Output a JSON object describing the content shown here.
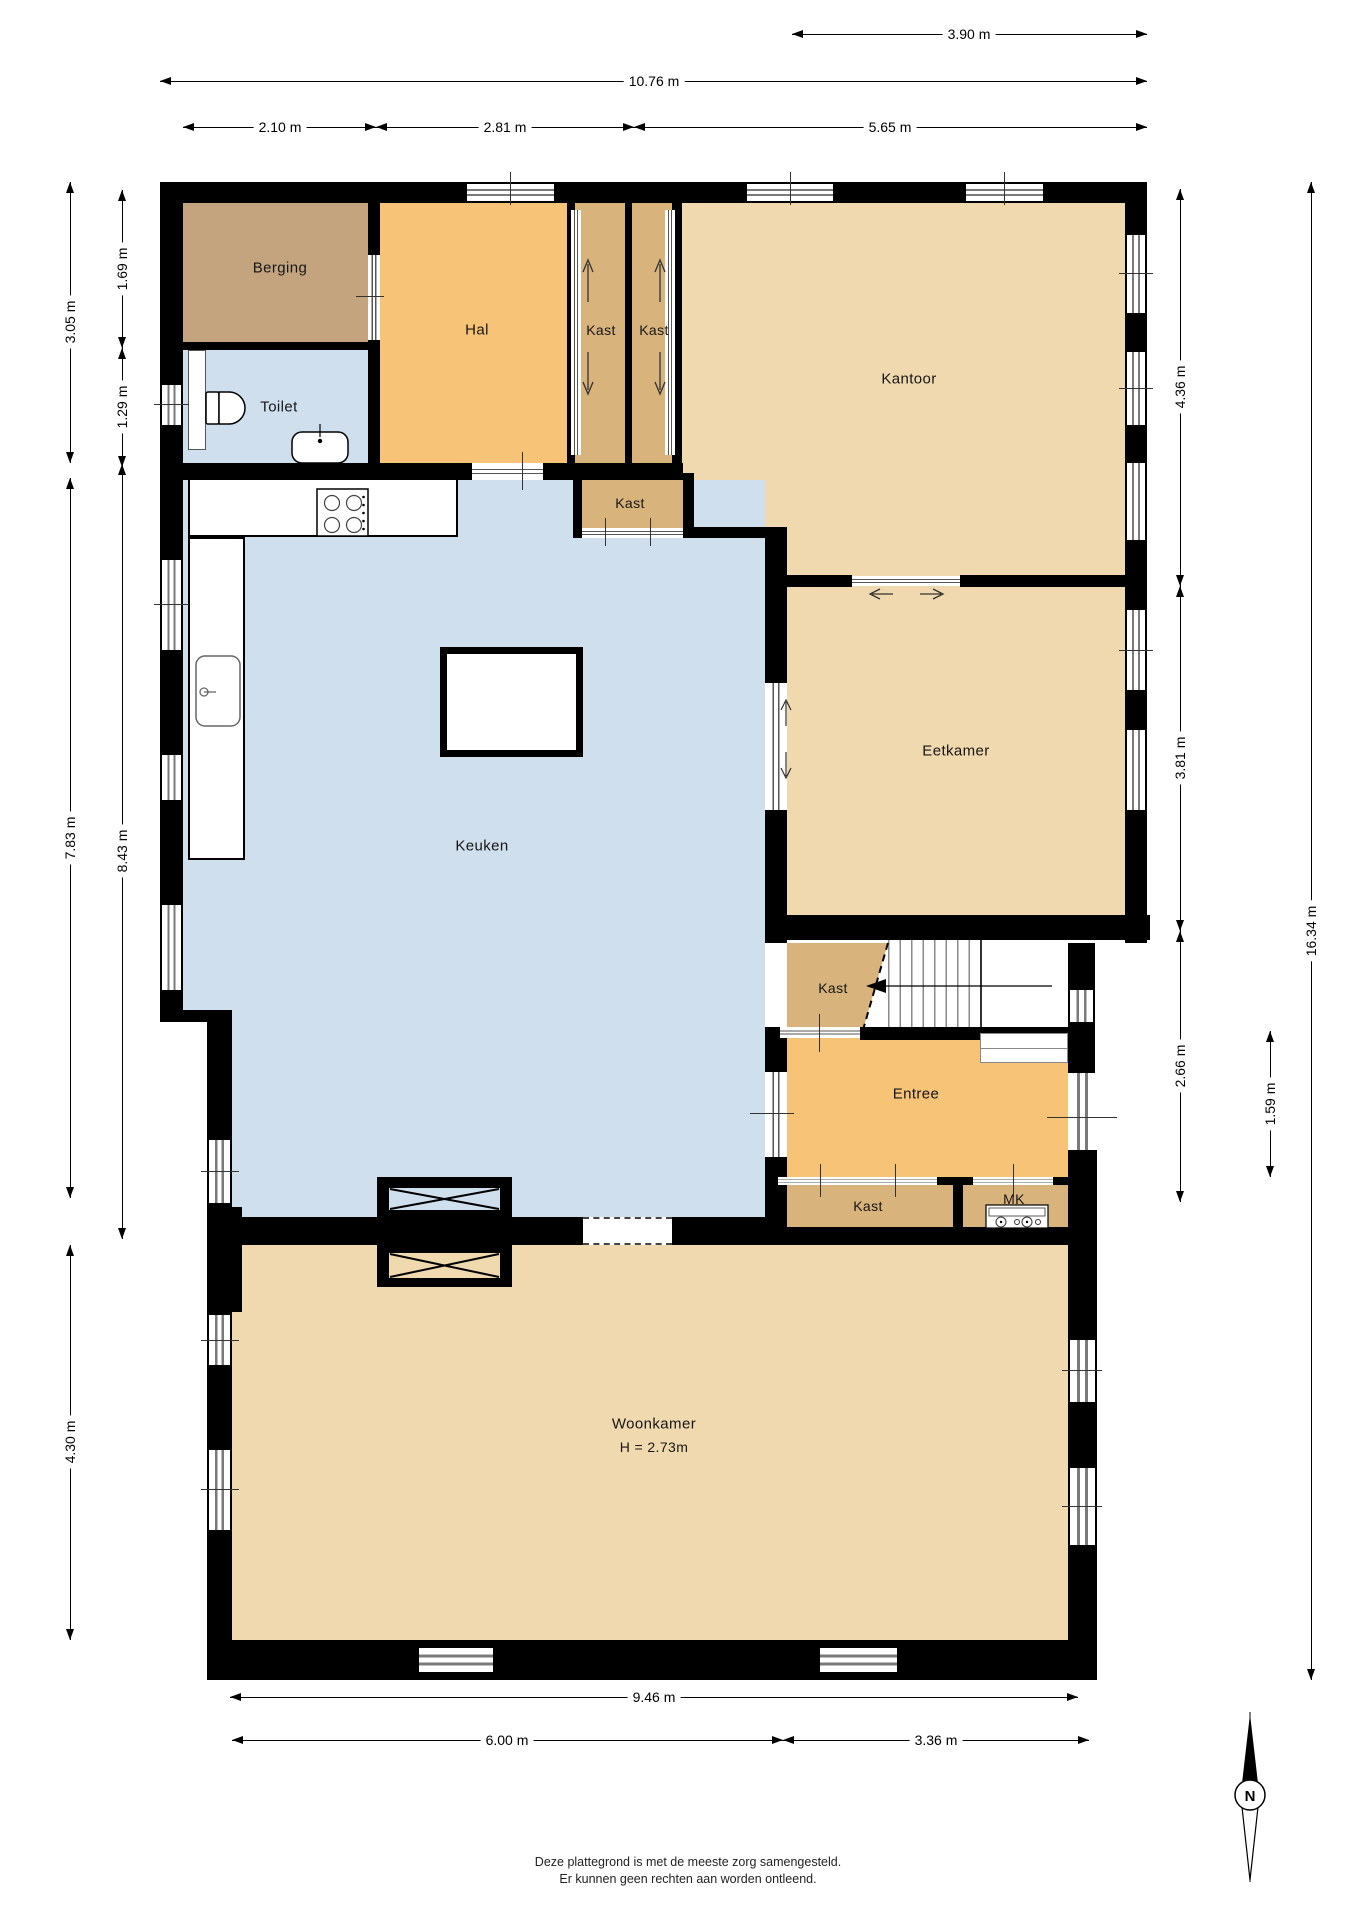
{
  "rooms": {
    "berging": "Berging",
    "toilet": "Toilet",
    "hal": "Hal",
    "kast": "Kast",
    "kantoor": "Kantoor",
    "keuken": "Keuken",
    "eetkamer": "Eetkamer",
    "entree": "Entree",
    "mk": "MK",
    "woonkamer": "Woonkamer",
    "woonkamer_height": "H = 2.73m"
  },
  "dimensions": {
    "top_3_90": "3.90 m",
    "top_10_76": "10.76 m",
    "top_2_10": "2.10 m",
    "top_2_81": "2.81 m",
    "top_5_65": "5.65 m",
    "left_3_05": "3.05 m",
    "left_1_69": "1.69 m",
    "left_1_29": "1.29 m",
    "left_7_83": "7.83 m",
    "left_8_43": "8.43 m",
    "left_4_30": "4.30 m",
    "right_4_36": "4.36 m",
    "right_3_81": "3.81 m",
    "right_2_66": "2.66 m",
    "right_16_34": "16.34 m",
    "right_1_59": "1.59 m",
    "bottom_9_46": "9.46 m",
    "bottom_6_00": "6.00 m",
    "bottom_3_36": "3.36 m"
  },
  "footer": {
    "line1": "Deze plattegrond is met de meeste zorg samengesteld.",
    "line2": "Er kunnen geen rechten aan worden ontleend."
  },
  "compass": {
    "north": "N"
  },
  "colors": {
    "wall": "#000000",
    "orange": "#f6c377",
    "berging": "#c3a47f",
    "kast": "#d8b37c",
    "light": "#f0d9ae",
    "blue": "#d0dfee",
    "window_line": "#7a7a7a"
  }
}
